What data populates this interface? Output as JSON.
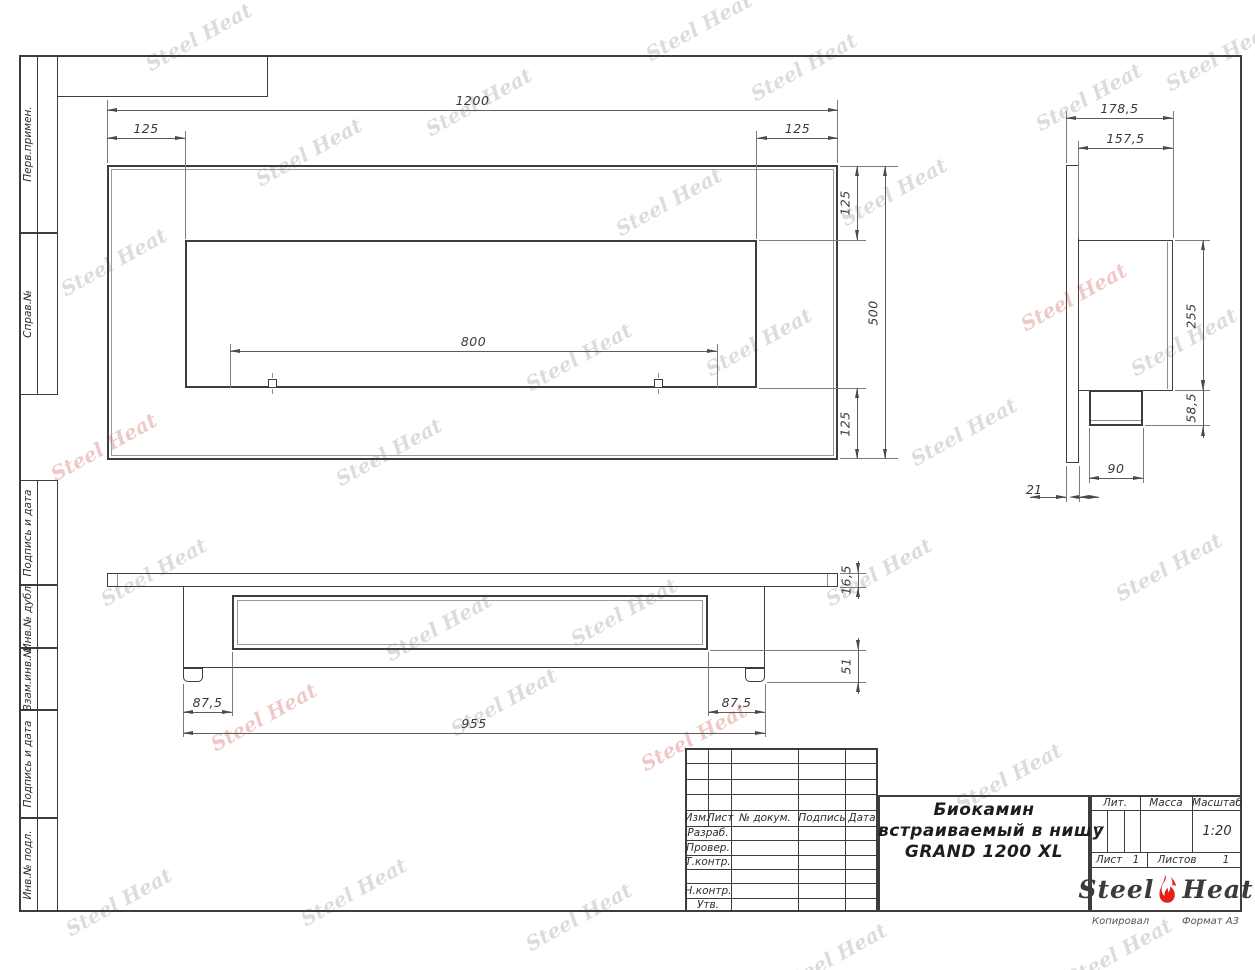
{
  "sheet": {
    "copied_label": "Копировал",
    "format_label": "Формат А3"
  },
  "watermark_text": "Steel Heat",
  "sidebar": {
    "top_cells": [
      "Перв.примен.",
      "Справ.№"
    ],
    "bottom_cells": [
      "Подпись и дата",
      "Инв.№ дубл.",
      "Взам.инв.№",
      "Подпись и дата",
      "Инв.№ подл."
    ]
  },
  "views": {
    "front": {
      "dims": {
        "width_total": "1200",
        "left_offset": "125",
        "right_offset": "125",
        "burner_width": "800",
        "top_offset": "125",
        "height_total": "500",
        "bottom_offset": "125"
      }
    },
    "side": {
      "dims": {
        "depth_total": "178,5",
        "inner_depth": "157,5",
        "body_height": "255",
        "burner_height": "58,5",
        "burner_depth": "90",
        "flange_thickness": "21"
      }
    },
    "bottom": {
      "dims": {
        "flange_thickness": "16,5",
        "base_height": "51",
        "left_offset": "87,5",
        "right_offset": "87,5",
        "body_width": "955"
      }
    }
  },
  "title_block": {
    "revision_headers": [
      "Изм.",
      "Лист",
      "№ докум.",
      "Подпись",
      "Дата"
    ],
    "role_rows": [
      "Разраб.",
      "Провер.",
      "Т.контр.",
      "",
      "Н.контр.",
      "Утв."
    ],
    "doc_title_lines": [
      "Биокамин",
      "встраиваемый в нишу",
      "GRAND 1200 XL"
    ],
    "lit_label": "Лит.",
    "lit_value": "0",
    "mass_label": "Масса",
    "mass_value": "",
    "scale_label": "Масштаб",
    "scale_value": "1:20",
    "sheet_label": "Лист",
    "sheet_value": "1",
    "sheets_label": "Листов",
    "sheets_value": "1",
    "brand": {
      "part1": "Steel",
      "part2": "Heat"
    },
    "colors": {
      "flame_red": "#e32119",
      "line": "#3d3d3d"
    }
  }
}
